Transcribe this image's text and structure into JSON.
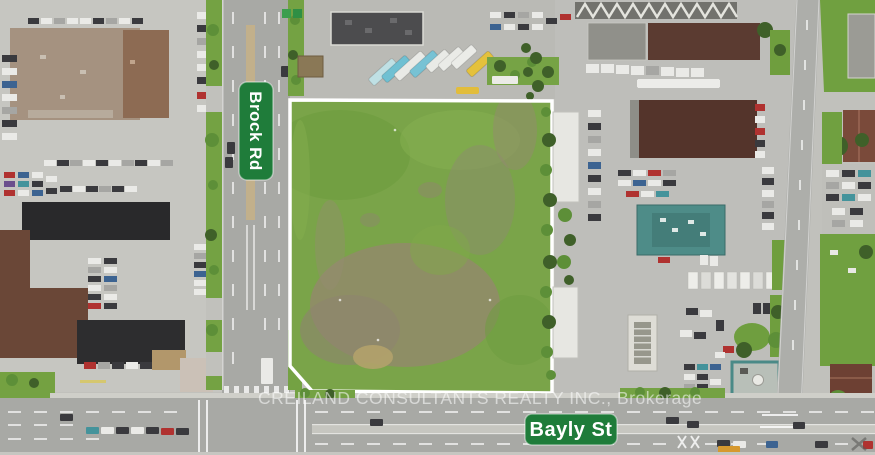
{
  "image": {
    "kind": "aerial-photograph",
    "subject": "Vacant land parcel outlined in white at the corner of Brock Rd and Bayly St"
  },
  "signs": {
    "vertical_road": "Brock Rd",
    "horizontal_road": "Bayly St"
  },
  "watermark": {
    "text": "CREILAND CONSULTANTS REALTY INC., Brokerage"
  },
  "colors": {
    "sign_green": "#1f7c3a",
    "sign_text": "#ffffff",
    "parcel_outline": "#ffffff",
    "parcel_grass": "#7aa449",
    "asphalt": "#a8a9a5",
    "pavement": "#c1c1bc"
  }
}
